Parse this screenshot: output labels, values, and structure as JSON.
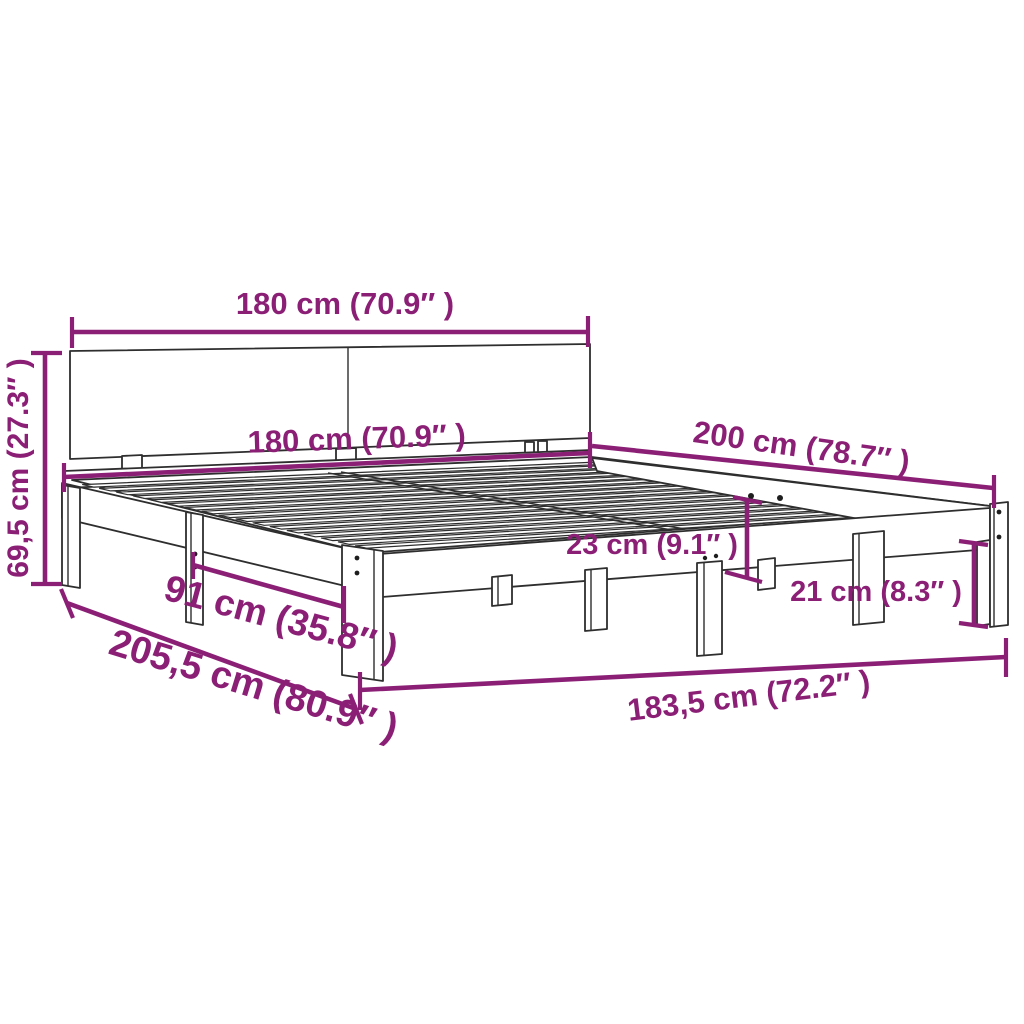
{
  "diagram": {
    "kind": "product-dimension-diagram",
    "subject": "wooden bed frame with split headboard, slatted base and legs",
    "accent_color": "#8B1F76",
    "outline_color": "#2E2E2E",
    "background_color": "#FFFFFF",
    "dimensions": [
      {
        "id": "headboard-width",
        "label": "180 cm (70.9″ )"
      },
      {
        "id": "headboard-height",
        "label": "69,5 cm (27.3″ )"
      },
      {
        "id": "bed-width",
        "label": "180 cm (70.9″ )"
      },
      {
        "id": "bed-length",
        "label": "200 cm (78.7″ )"
      },
      {
        "id": "frame-depth",
        "label": "23 cm (9.1″ )"
      },
      {
        "id": "leg-clearance",
        "label": "21 cm (8.3″ )"
      },
      {
        "id": "leg-spacing",
        "label": "91 cm (35.8″ )"
      },
      {
        "id": "total-length",
        "label": "205,5 cm (80.9″ )"
      },
      {
        "id": "outer-width",
        "label": "183,5 cm (72.2″ )"
      }
    ]
  }
}
